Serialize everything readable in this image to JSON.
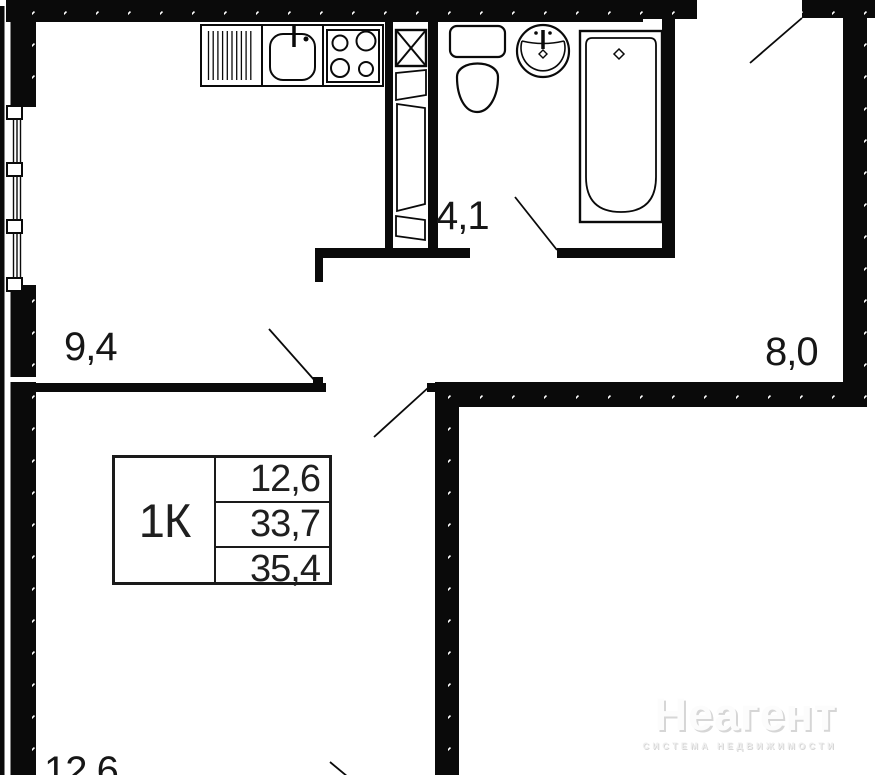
{
  "plan": {
    "unit_type": "1К",
    "rooms": [
      {
        "name": "kitchen",
        "area": "9,4"
      },
      {
        "name": "bathroom",
        "area": "4,1"
      },
      {
        "name": "hallway",
        "area": "8,0"
      },
      {
        "name": "living-room",
        "area": "12,6"
      }
    ],
    "info_table": {
      "unit_label": "1К",
      "rows": [
        {
          "value": "12,6"
        },
        {
          "value": "33,7"
        },
        {
          "value": "35,4"
        }
      ]
    },
    "watermark": {
      "brand": "Неагент",
      "tagline": "СИСТЕМА НЕДВИЖИМОСТИ"
    },
    "colors": {
      "wall": "#0a0a0a",
      "line": "#0a0a0a",
      "background": "#ffffff",
      "watermark_text": "#fcfcfc",
      "watermark_shadow": "#d6d6d6"
    },
    "fixtures": [
      "dish-drainer-icon",
      "kitchen-sink-icon",
      "stove-icon",
      "ventilation-shaft-icon",
      "toilet-icon",
      "washbasin-icon",
      "bathtub-icon",
      "window-icon",
      "door-swing-icon"
    ]
  }
}
